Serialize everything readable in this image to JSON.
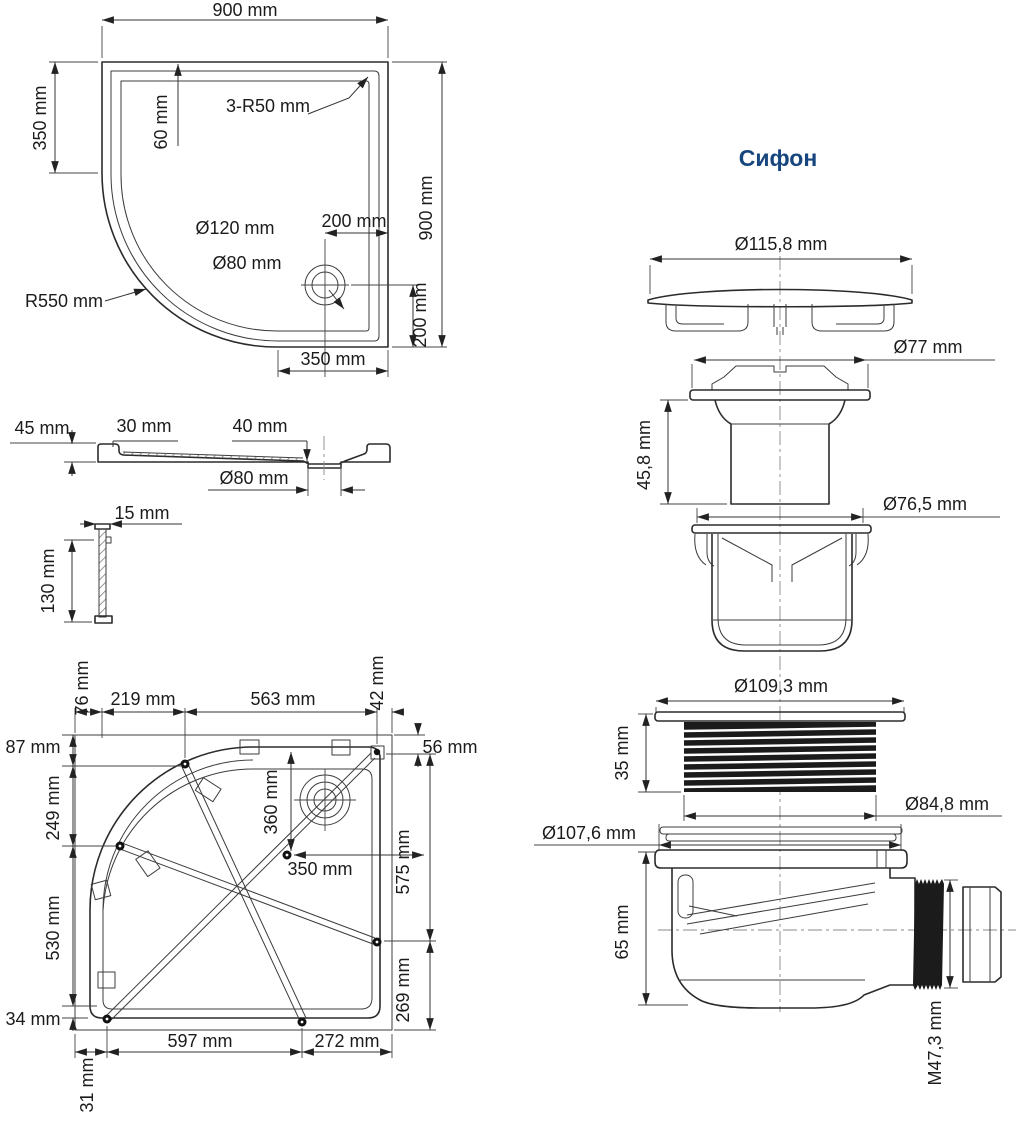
{
  "siphon": {
    "title": "Сифон",
    "labels": {
      "cap_diameter": "Ø115,8 mm",
      "flange_diameter": "Ø77 mm",
      "funnel_height": "45,8 mm",
      "cup_diameter": "Ø76,5 mm",
      "thread_outer_diameter": "Ø109,3 mm",
      "thread_height": "35 mm",
      "thread_inner_diameter": "Ø84,8 mm",
      "gasket_diameter": "Ø107,6 mm",
      "trap_height": "65 mm",
      "outlet_thread": "M47,3 mm"
    }
  },
  "tray_top_view": {
    "width": "900 mm",
    "left_offset": "350 mm",
    "rim_offset": "60 mm",
    "corner_radius": "3-R50 mm",
    "height": "900 mm",
    "drain_offset_x": "200 mm",
    "drain_outer_diameter": "Ø120 mm",
    "drain_diameter": "Ø80 mm",
    "front_radius": "R550 mm",
    "drain_offset_y": "200 mm",
    "drain_edge_distance": "350 mm"
  },
  "tray_section_view": {
    "rim_height": "45 mm",
    "rim_width": "30 mm",
    "depth": "40 mm",
    "drain_hole": "Ø80 mm"
  },
  "panel_detail": {
    "thickness": "15 mm",
    "height": "130 mm"
  },
  "tray_bottom_view": {
    "top_edge_76": "76 mm",
    "top_219": "219 mm",
    "top_563": "563 mm",
    "top_edge_42": "42 mm",
    "left_87": "87 mm",
    "left_249": "249 mm",
    "left_530": "530 mm",
    "left_34": "34 mm",
    "bottom_left_31": "31 mm",
    "right_56": "56 mm",
    "right_575": "575 mm",
    "right_269": "269 mm",
    "center_360": "360 mm",
    "center_350": "350 mm",
    "bottom_597": "597 mm",
    "bottom_272": "272 mm"
  },
  "colors": {
    "line": "#2b2b2b",
    "dimension": "#333333",
    "title_accent": "#17457d",
    "thread_fill": "#1b1b1b",
    "background": "#ffffff"
  }
}
